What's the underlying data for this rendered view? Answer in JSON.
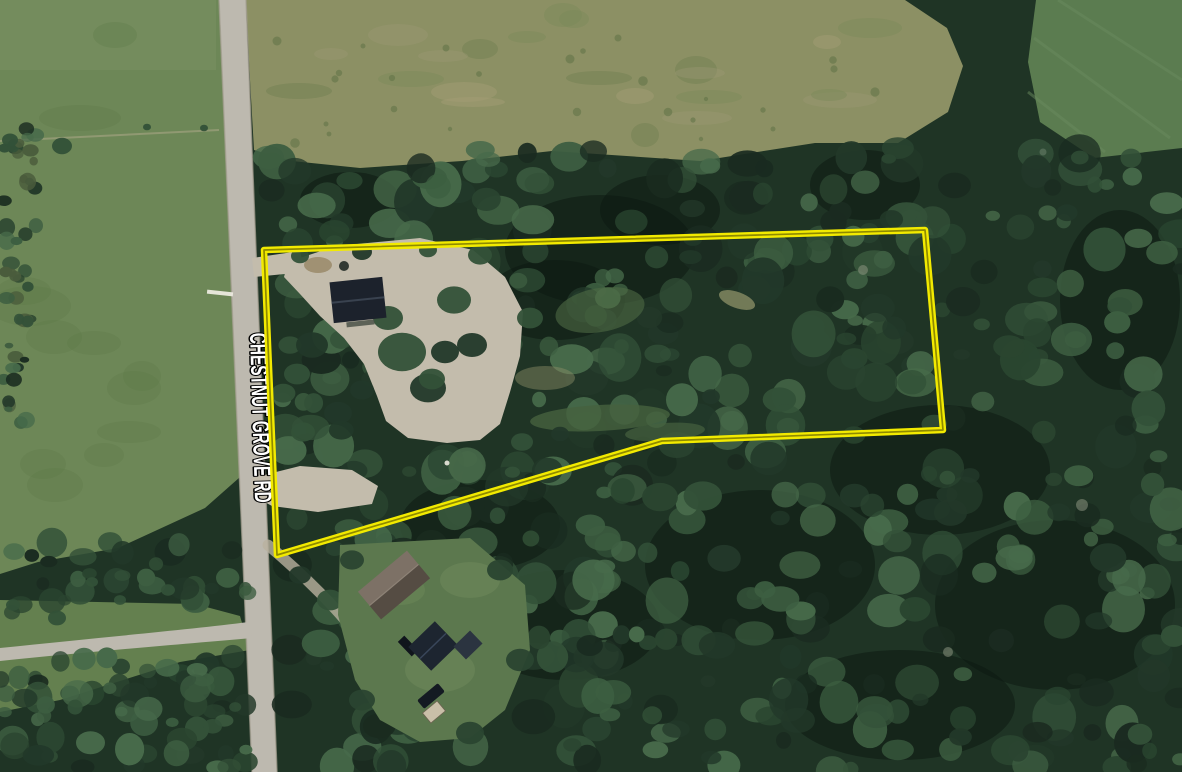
{
  "map": {
    "description": "Aerial satellite photo of a wooded rural property with a highlighted parcel boundary along Chestnut Grove Rd",
    "road_label": "CHESTNUT GROVE RD",
    "parcel": {
      "points": "264,250 925,230 943,430 662,441 277,555",
      "vertex_count": 5
    }
  },
  "colors": {
    "parcel_outline": "#f2ea00",
    "parcel_outline_core": "#8f8a00",
    "road_label_fill": "#ffffff",
    "road_label_outline": "#000000",
    "forest_base": "#1f3425",
    "forest_shadow": "#0d1a12",
    "canopy_shades": [
      "#1a2b20",
      "#223829",
      "#2a4530",
      "#335138",
      "#3d5e41",
      "#476a4a"
    ],
    "pasture": "#6d8757",
    "pasture_light": "#7b9163",
    "meadow": "#8c9064",
    "meadow_mottles": [
      "#9a9770",
      "#7b8a59",
      "#a59d75",
      "#6f7f50"
    ],
    "crop_field": "#5b7c50",
    "crop_field_stripe": "#6a8a5e",
    "roadside_grass": "#64804f",
    "road_surface": "#bdb9af",
    "road_edge": "#a49e90",
    "gravel": "#c3bcac",
    "dirt": "#9a8a68",
    "yard_grass": "#5c784e",
    "dark_roof": "#1c222c",
    "dark_roof_ridge": "#39424f",
    "brown_roof": "#7d7166",
    "brown_roof_dark": "#554c43",
    "navy_roof": "#1d2530",
    "shed_roof": "#2b3440",
    "tan_shed": "#c9bfa8",
    "vehicle_dark": "#141a22",
    "white_detail": "#eceadf"
  }
}
